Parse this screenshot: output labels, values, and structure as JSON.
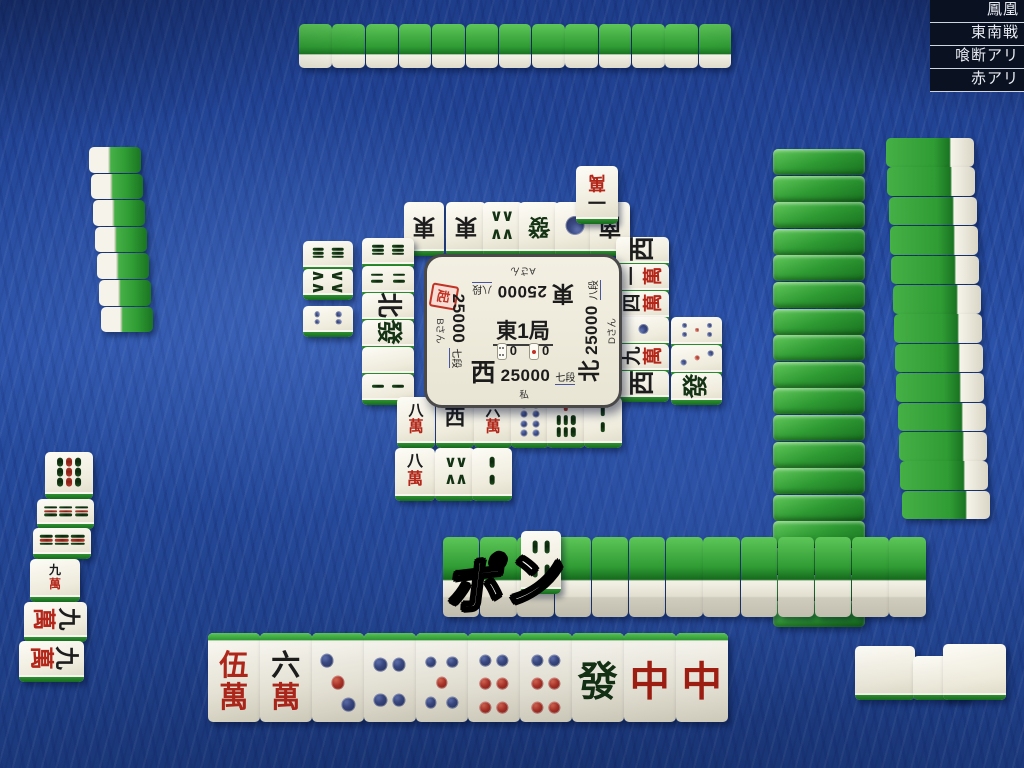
{
  "rules_panel": {
    "room": "鳳凰",
    "game_type": "東南戦",
    "rule1": "喰断アリ",
    "rule2": "赤アリ"
  },
  "center_panel": {
    "round": "東1局",
    "honba": "0",
    "riichi_sticks": "0",
    "dealer_marker": "起",
    "players": {
      "self": {
        "wind": "西",
        "score": "25000",
        "rank": "七段",
        "name": "私"
      },
      "right": {
        "wind": "北",
        "score": "25000",
        "rank": "八段",
        "name": "Dさん"
      },
      "top": {
        "wind": "東",
        "score": "25000",
        "rank": "八段",
        "name": "Aさん"
      },
      "left": {
        "wind": "南",
        "score": "25000",
        "rank": "七段",
        "name": "Bさん"
      }
    }
  },
  "call_announcement": "ポン",
  "tiles": {
    "bottom_hand": [
      "0m",
      "6m",
      "3p",
      "4p",
      "5p",
      "6p",
      "6p",
      "F",
      "C",
      "C"
    ],
    "bottom_meld": [
      "P",
      "P",
      "P"
    ],
    "left_melds": [
      "9s",
      "9s",
      "9s",
      "9m",
      "9m",
      "9m"
    ],
    "dora_indicator": "4s",
    "discards": {
      "top": [
        [
          "E",
          "E",
          "8s",
          "F",
          "1p",
          "S"
        ],
        [
          "1m"
        ]
      ],
      "left": [
        [
          "6s",
          "4s",
          "N",
          "F",
          "P",
          "2s"
        ],
        [
          "6s",
          "8s",
          "4p"
        ]
      ],
      "right": [
        [
          "W",
          "1m",
          "4m",
          "1p",
          "9m",
          "W"
        ],
        [
          "5p",
          "3p",
          "F"
        ]
      ],
      "bottom": [
        [
          "8m",
          "W",
          "6m",
          "8p",
          "7s",
          "2s"
        ],
        [
          "8m",
          "8s",
          "2s"
        ]
      ]
    },
    "counts": {
      "top_hand": 13,
      "left_hand": 7,
      "right_hand": 13,
      "right_wall": 18,
      "bottom_wall": 13
    }
  }
}
